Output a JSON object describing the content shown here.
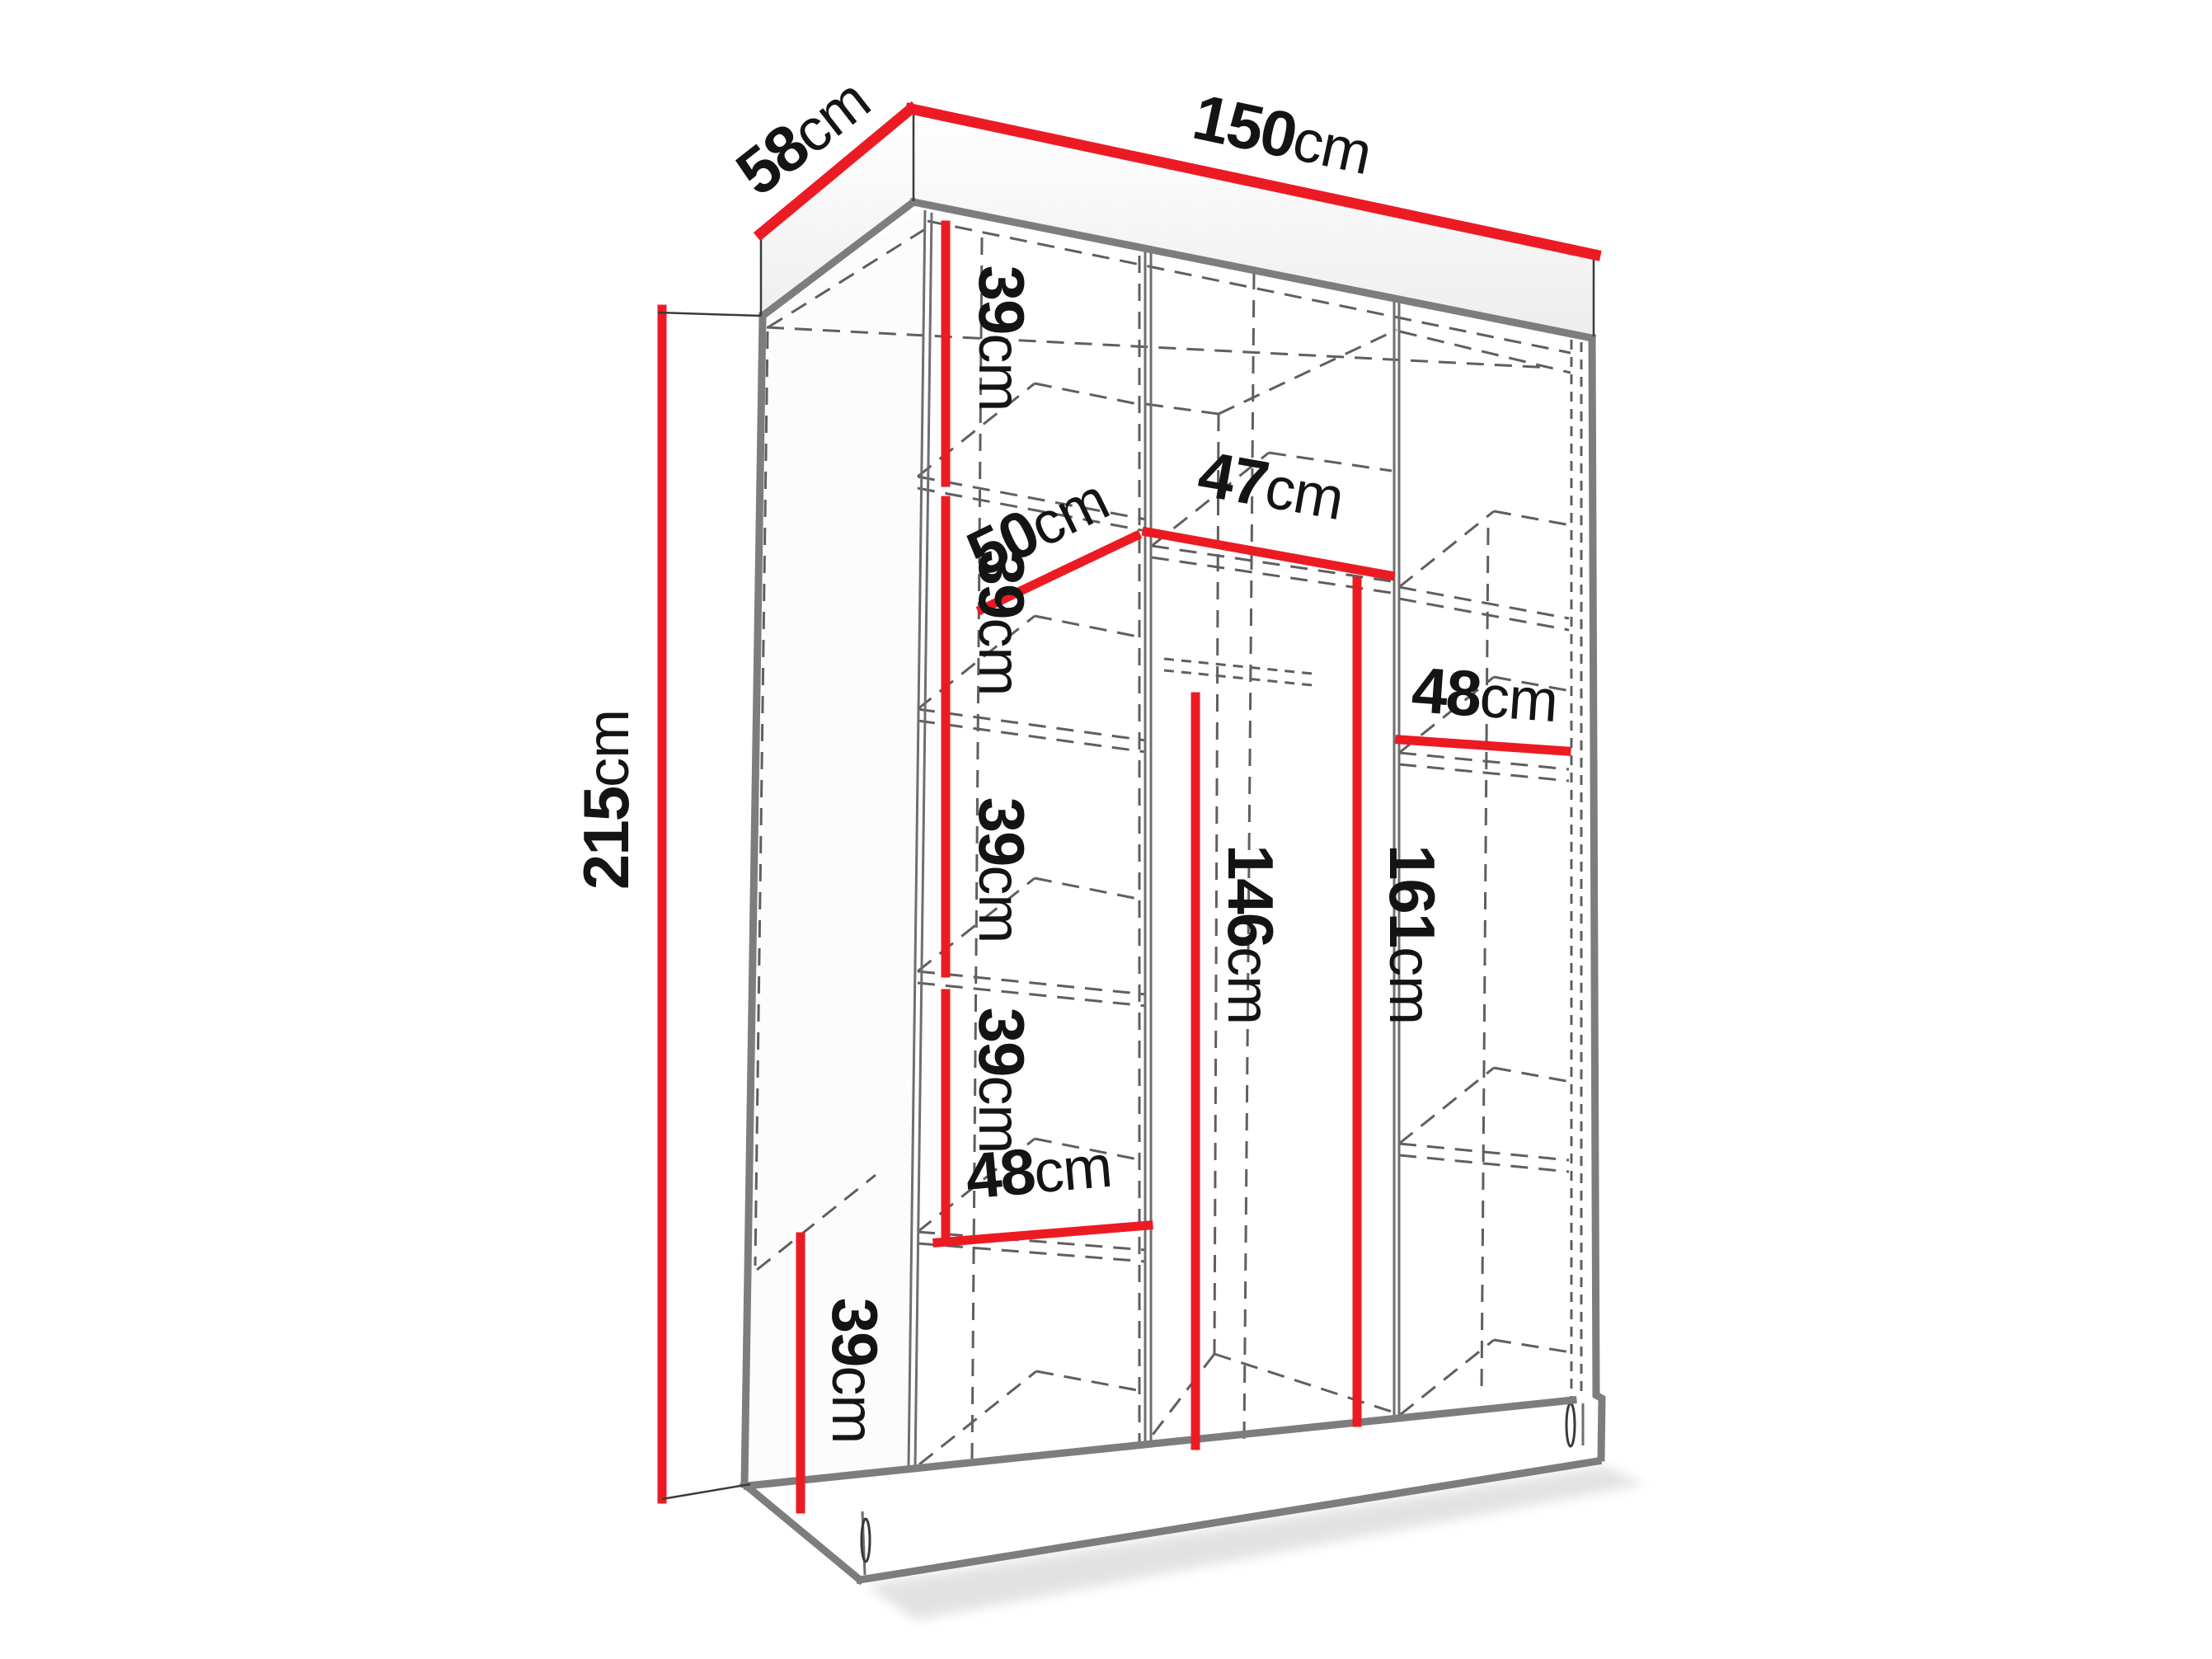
{
  "diagram": {
    "name": "wardrobe-dimension-diagram",
    "unit": "cm",
    "dimensions": {
      "overall_width": {
        "value": "150",
        "unit": "cm"
      },
      "overall_depth": {
        "value": "58",
        "unit": "cm"
      },
      "overall_height": {
        "value": "215",
        "unit": "cm"
      },
      "left_shelf_1": {
        "value": "39",
        "unit": "cm"
      },
      "shelf_depth": {
        "value": "50",
        "unit": "cm"
      },
      "middle_section_width": {
        "value": "47",
        "unit": "cm"
      },
      "left_shelf_2": {
        "value": "39",
        "unit": "cm"
      },
      "left_shelf_3": {
        "value": "39",
        "unit": "cm"
      },
      "left_shelf_4": {
        "value": "39",
        "unit": "cm"
      },
      "left_section_width": {
        "value": "48",
        "unit": "cm"
      },
      "left_shelf_bottom": {
        "value": "39",
        "unit": "cm"
      },
      "right_section_width": {
        "value": "48",
        "unit": "cm"
      },
      "middle_hanging_height": {
        "value": "146",
        "unit": "cm"
      },
      "right_hanging_height": {
        "value": "161",
        "unit": "cm"
      }
    }
  },
  "colors": {
    "dimension_line": "#ec1b23",
    "edge_gray": "#7d7d7d",
    "hidden_line_gray": "#5f5f5f",
    "label_text": "#141414",
    "background": "#ffffff"
  }
}
